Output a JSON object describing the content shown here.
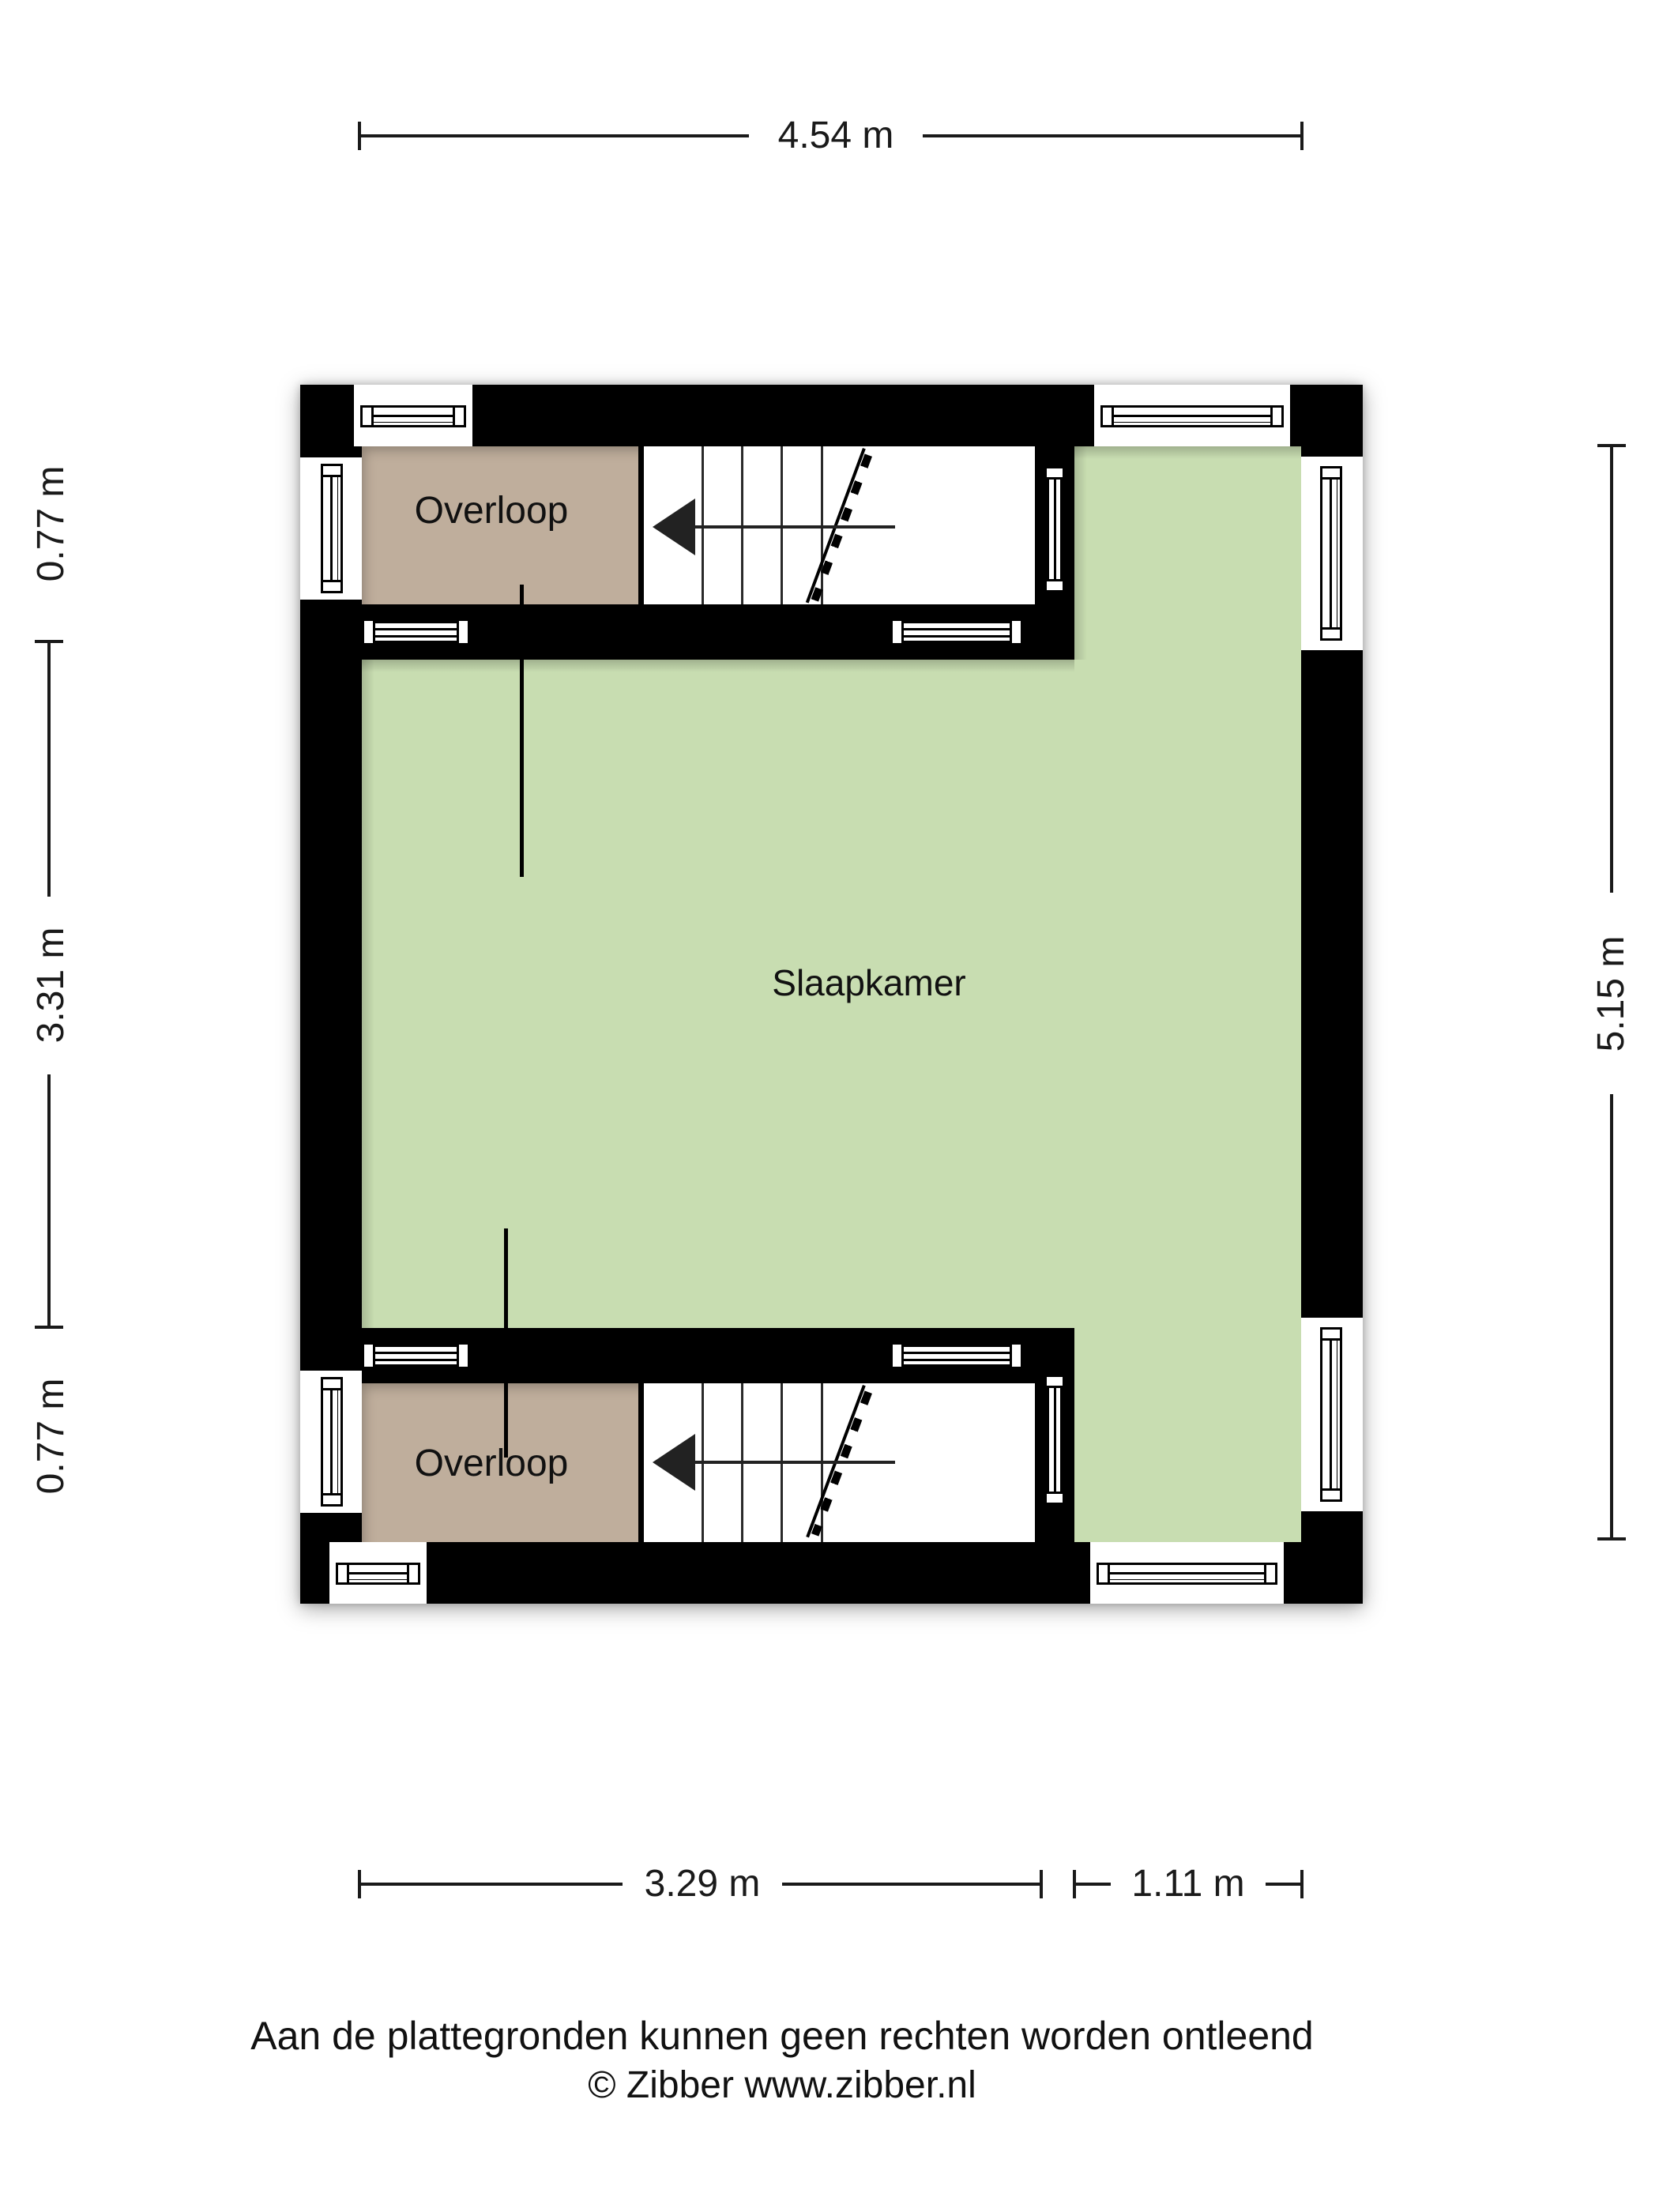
{
  "plan": {
    "rooms": {
      "overloop_top": "Overloop",
      "slaapkamer": "Slaapkamer",
      "overloop_bottom": "Overloop"
    }
  },
  "dimensions": {
    "top": "4.54 m",
    "left_top": "0.77 m",
    "left_middle": "3.31 m",
    "left_bottom": "0.77 m",
    "right": "5.15 m",
    "bottom_left": "3.29 m",
    "bottom_right": "1.11 m"
  },
  "footer": {
    "disclaimer": "Aan de plattegronden kunnen geen rechten worden ontleend",
    "credit": "© Zibber www.zibber.nl"
  },
  "colors": {
    "wall": "#000000",
    "room_green": "#c8ddb1",
    "room_beige": "#bfae9c",
    "floor_white": "#ffffff"
  }
}
